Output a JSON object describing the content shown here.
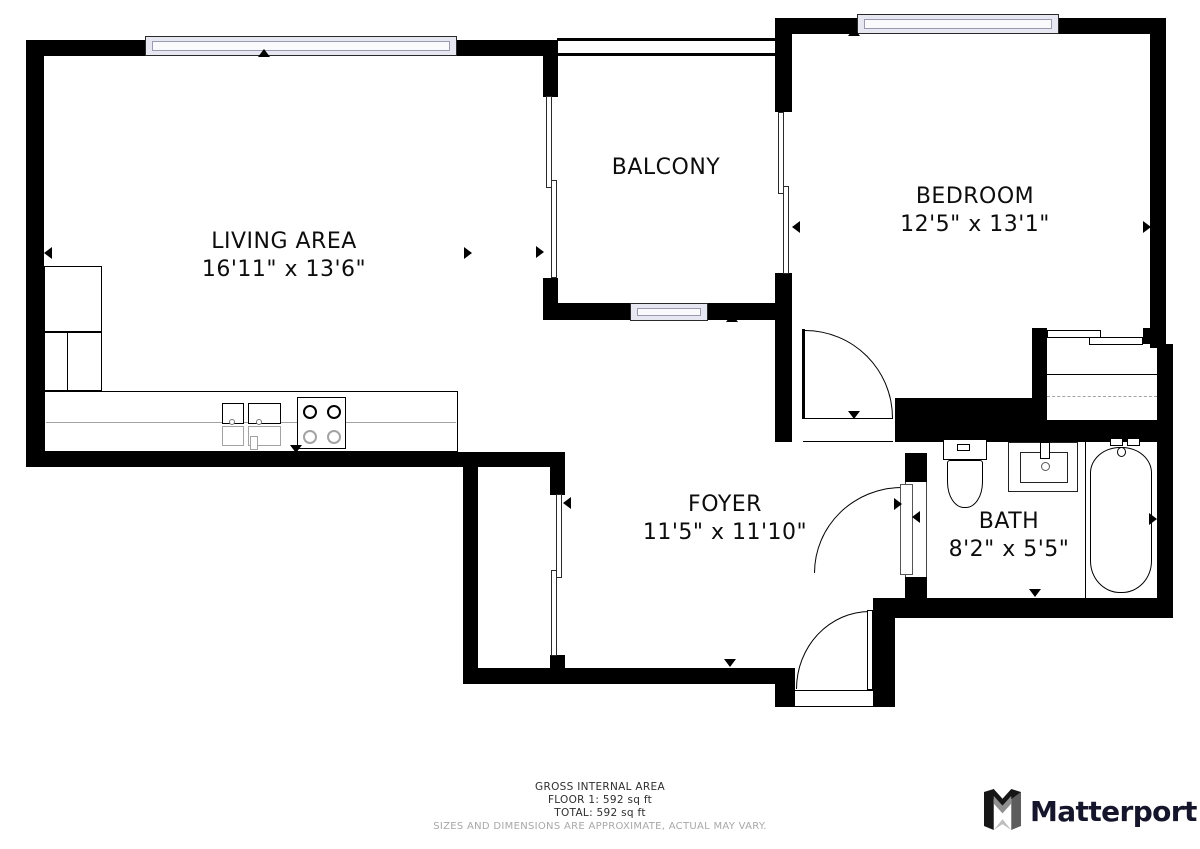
{
  "title": "Apartment floor plan",
  "rooms": [
    {
      "name": "LIVING AREA",
      "dims": "16'11\" x 13'6\""
    },
    {
      "name": "BALCONY",
      "dims": ""
    },
    {
      "name": "BEDROOM",
      "dims": "12'5\" x 13'1\""
    },
    {
      "name": "FOYER",
      "dims": "11'5\" x 11'10\""
    },
    {
      "name": "BATH",
      "dims": "8'2\" x 5'5\""
    }
  ],
  "footer": {
    "area_title": "GROSS INTERNAL AREA",
    "floor_line": "FLOOR 1: 592 sq ft",
    "total_line": "TOTAL: 592 sq ft",
    "disclaimer": "SIZES AND DIMENSIONS ARE APPROXIMATE, ACTUAL MAY VARY."
  },
  "brand": {
    "name": "Matterport"
  },
  "colors": {
    "wall": "#000000",
    "window_fill": "#e7e7f2",
    "fixture_gray": "#a3a3a3",
    "disclaimer_gray": "#a8a8a8",
    "brand_color": "#15162b"
  }
}
